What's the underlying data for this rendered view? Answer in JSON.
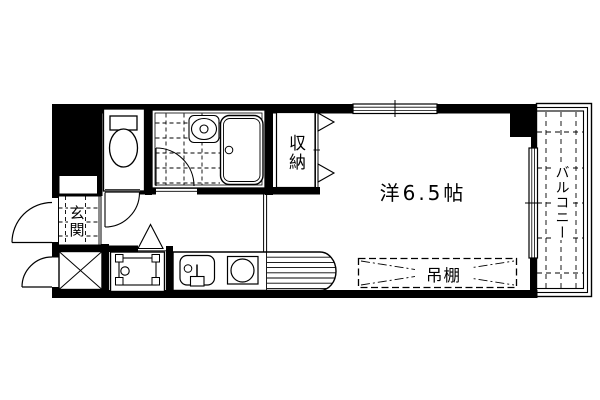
{
  "floor_plan": {
    "labels": {
      "main_room": "洋6.5帖",
      "balcony": "バルコニー",
      "closet": "収納",
      "entrance": "玄関",
      "hanging_shelf": "吊棚"
    },
    "colors": {
      "line": "#000000",
      "background": "#ffffff"
    }
  }
}
